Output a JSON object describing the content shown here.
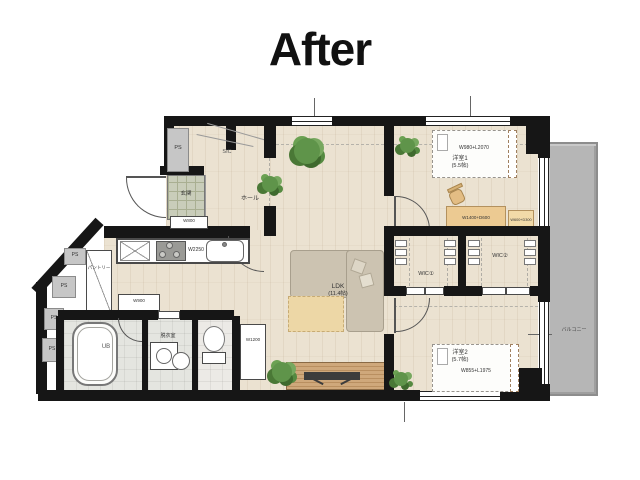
{
  "title": "After",
  "labels": {
    "entrance": "玄関",
    "hall": "ホール",
    "sic": "SIC",
    "ps": "PS",
    "pantry": "パントリー",
    "shoe_cabinet": "W800",
    "kitchen_counter": "W2250",
    "kitchen_cabinet": "W900",
    "bath": "UB",
    "washroom": "脱衣室",
    "toilet": "トイレ",
    "cabinet": "W1200",
    "ldk": "LDK",
    "ldk_size": "(11.4帖)",
    "bedroom1": "洋室1",
    "bedroom1_size": "(5.5帖)",
    "bed1": "W980+L2070",
    "desk": "W1400+D600",
    "shelf": "W600+D300",
    "wic1": "WIC①",
    "wic2": "WIC②",
    "bedroom2": "洋室2",
    "bedroom2_size": "(5.7帖)",
    "bed2": "W855+L1975",
    "balcony": "バルコニー"
  },
  "colors": {
    "wall": "#161616",
    "wood_floor": "#ebe2d1",
    "entrance_tile": "#c9cdba",
    "balcony": "#b6b6b6",
    "plant_green": "#5f944a",
    "sofa": "#ccc3b1",
    "rug": "#edd7a6",
    "desk_wood": "#ecca92",
    "tv_board": "#c49a6c"
  }
}
